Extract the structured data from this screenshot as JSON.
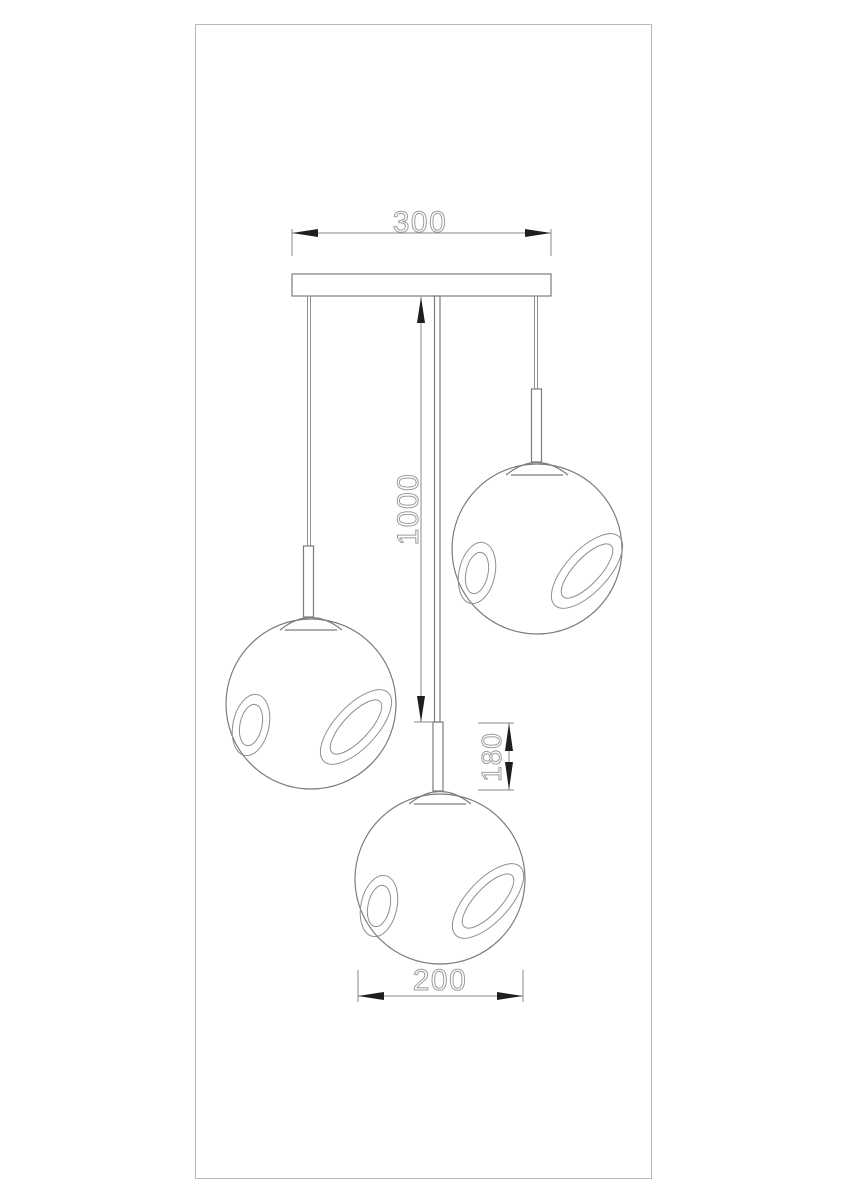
{
  "colors": {
    "background": "#ffffff",
    "line": "#7c7c7c",
    "thin_line": "#8f8f8f",
    "dim_line": "#8a8a8a",
    "dim_text": "#9c9c9c",
    "arrow": "#1e1e1e",
    "border": "#b9b9b9"
  },
  "drawing": {
    "dimensions": {
      "canopy_width_label": "300",
      "drop_height_label": "1000",
      "stem_length_label": "180",
      "shade_diameter_label": "200"
    }
  }
}
